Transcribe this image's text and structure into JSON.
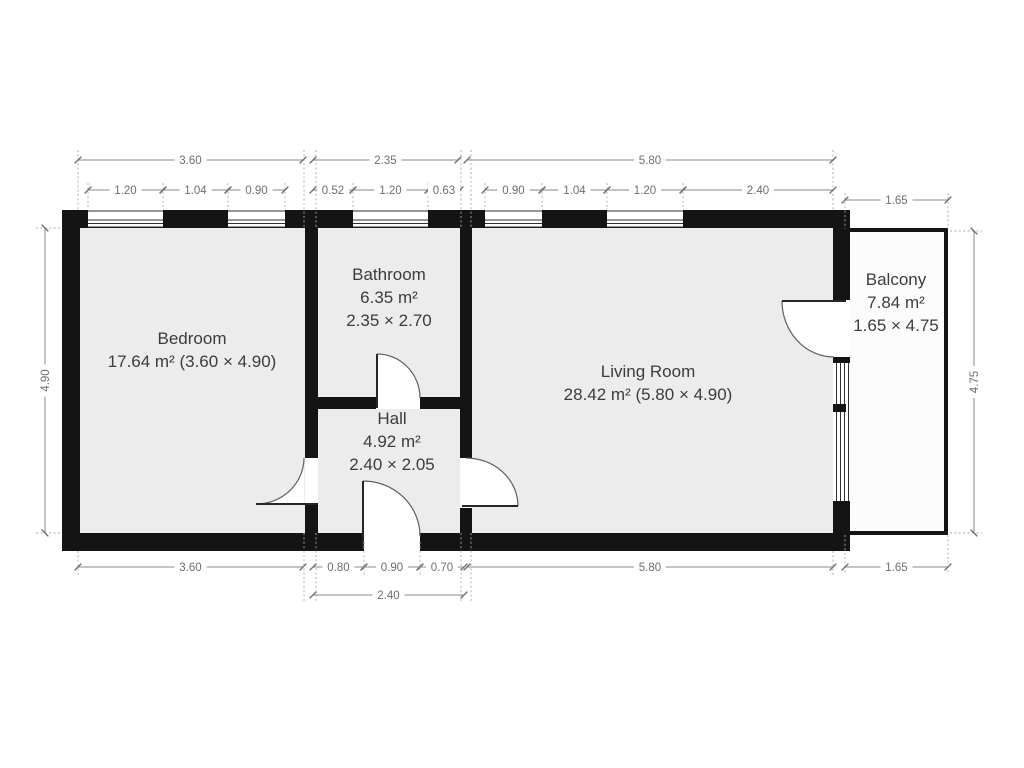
{
  "colors": {
    "wall": "#141414",
    "floor": "#ececec",
    "balcony_floor": "#fcfcfc"
  },
  "rooms": {
    "bedroom": {
      "name": "Bedroom",
      "details": "17.64 m² (3.60 × 4.90)"
    },
    "bathroom": {
      "name": "Bathroom",
      "area": "6.35 m²",
      "dims": "2.35 × 2.70"
    },
    "hall": {
      "name": "Hall",
      "area": "4.92 m²",
      "dims": "2.40 × 2.05"
    },
    "living_room": {
      "name": "Living Room",
      "details": "28.42 m² (5.80 × 4.90)"
    },
    "balcony": {
      "name": "Balcony",
      "area": "7.84 m²",
      "dims": "1.65 × 4.75"
    }
  },
  "dimensions": {
    "top_main": [
      "3.60",
      "2.35",
      "5.80"
    ],
    "top_sub": [
      "1.20",
      "1.04",
      "0.90",
      "0.52",
      "1.20",
      "0.63",
      "0.90",
      "1.04",
      "1.20",
      "2.40"
    ],
    "balcony_top": "1.65",
    "bottom_main": [
      "3.60",
      "0.80",
      "0.90",
      "0.70",
      "5.80",
      "1.65"
    ],
    "bottom_sub": "2.40",
    "left": "4.90",
    "right": "4.75"
  }
}
